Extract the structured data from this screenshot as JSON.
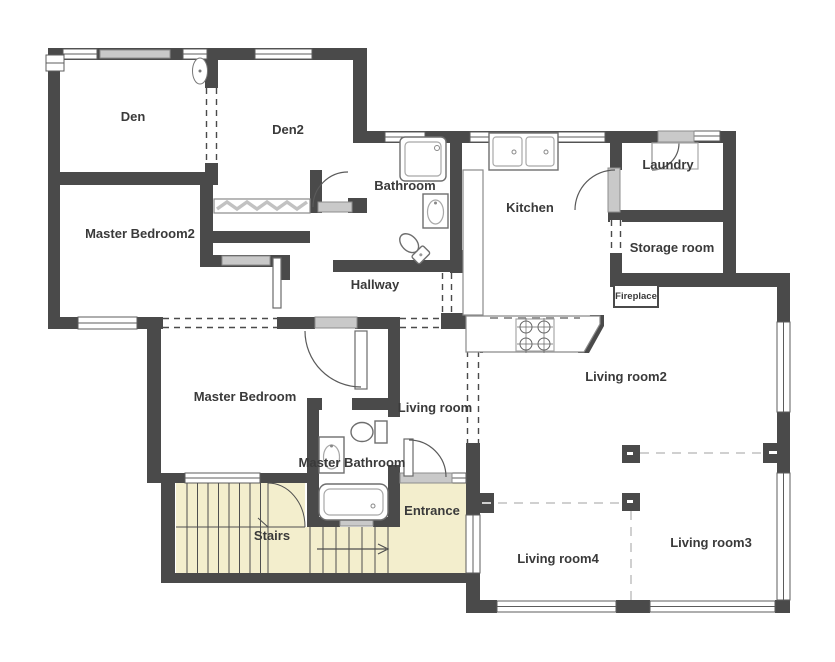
{
  "floorplan": {
    "colors": {
      "wall": "#4a4a4a",
      "stairs": "#f3eecd",
      "label": "#3a3a3a",
      "fixture": "#6e6e6e",
      "slider": "#c9c9c9",
      "separator": "#d0d0d0"
    },
    "rooms": {
      "den": "Den",
      "den2": "Den2",
      "bathroom": "Bathroom",
      "kitchen": "Kitchen",
      "laundry": "Laundry",
      "master_bedroom2": "Master Bedroom2",
      "storage_room": "Storage room",
      "hallway": "Hallway",
      "fireplace": "Fireplace",
      "living_room2": "Living room2",
      "master_bedroom": "Master Bedroom",
      "living_room": "Living room",
      "master_bathroom": "Master Bathroom",
      "entrance": "Entrance",
      "stairs": "Stairs",
      "living_room4": "Living room4",
      "living_room3": "Living room3"
    }
  }
}
